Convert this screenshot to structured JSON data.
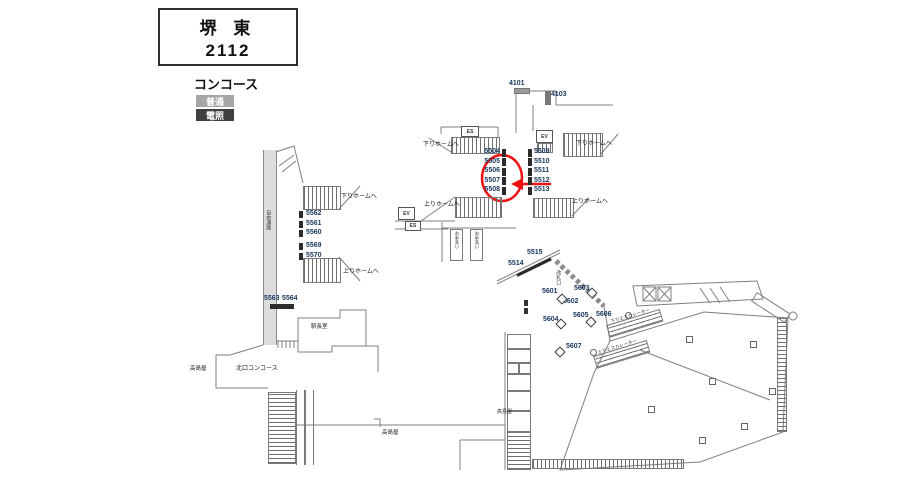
{
  "title": {
    "station": "堺 東",
    "code": "2112"
  },
  "area_label": "コンコース",
  "legend": [
    {
      "label": "普通",
      "type": "normal",
      "color": "#a6a6a6"
    },
    {
      "label": "電照",
      "type": "illuminated",
      "color": "#3f3f3f"
    }
  ],
  "colors": {
    "ad_number_text": "#17375e",
    "illuminated_bar": "#2b2b2b",
    "normal_bar": "#9a9a9a",
    "highlight": "#ee1111"
  },
  "ads": {
    "corridor": [
      "4101",
      "4103"
    ],
    "west_stack": [
      "5562",
      "5561",
      "5560",
      "5569",
      "5570"
    ],
    "west_pair": [
      "5563",
      "5564"
    ],
    "center_left": [
      "5504",
      "5505",
      "5506",
      "5507",
      "5508"
    ],
    "center_right": [
      "5509",
      "5510",
      "5511",
      "5512",
      "5513"
    ],
    "wall": [
      "5514",
      "5515"
    ],
    "pillars": [
      "5601",
      "5602",
      "5603",
      "5604",
      "5605",
      "5606",
      "5607"
    ]
  },
  "labels": {
    "to_down_platform": "下りホームへ",
    "to_up_platform": "上りホームへ",
    "elevator": "EV",
    "escalator": "ES",
    "station_office": "駅長室",
    "north_concourse": "北口コンコース",
    "takashimaya": "高島屋",
    "ticket_gate": "改札口",
    "restroom": "お手洗い",
    "passage": "自由通路",
    "down_escalator": "下りエスカレーター",
    "up_escalator": "上りエスカレーター"
  },
  "annotation": {
    "target": "5507",
    "style": "red circle with left arrow"
  }
}
